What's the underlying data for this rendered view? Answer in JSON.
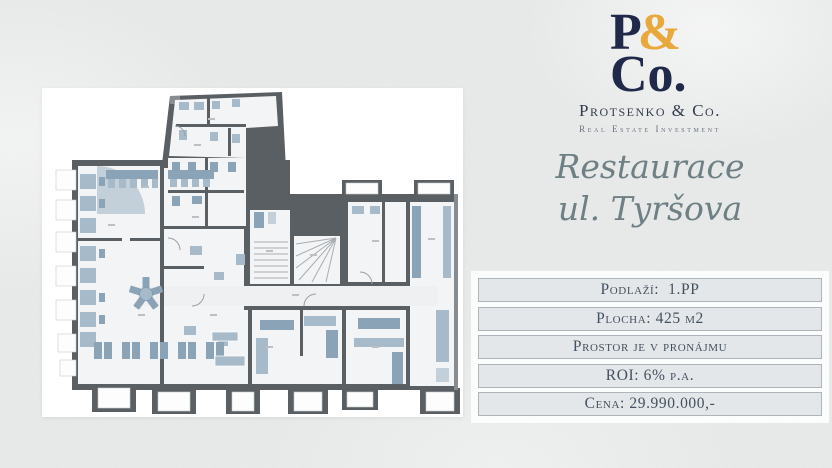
{
  "palette": {
    "page_bg": "#eaebea",
    "card_bg": "#ffffff",
    "wall": "#5a5f64",
    "wall_light": "#878c90",
    "floor": "#f3f4f5",
    "floor_dim": "#eef0f2",
    "furniture_light": "#a7bac9",
    "furniture_mid": "#8ba3b6",
    "furniture_pale": "#c3cfd9",
    "navy": "#20294a",
    "gold": "#e9a83b",
    "company_text": "#333c4b",
    "tagline_text": "#68737e",
    "script_text": "#6f8085",
    "table_text": "#43505f",
    "table_border": "#aeb5ba",
    "table_row_bg": "#e4e7e9"
  },
  "brand": {
    "logo_p": "P",
    "logo_amp": "&",
    "logo_co": "Co.",
    "company": "Protsenko & Co.",
    "tagline": "Real Estate Investment"
  },
  "listing": {
    "title_line1": "Restaurace",
    "title_line2": "ul. Tyršova"
  },
  "details": {
    "rows": [
      {
        "label": "Podlaží:  1.PP"
      },
      {
        "label": "Plocha: 425 m2"
      },
      {
        "label": "Prostor je v pronájmu"
      },
      {
        "label": "ROI: 6% p.a."
      },
      {
        "label": "Cena: 29.990.000,-"
      }
    ]
  }
}
